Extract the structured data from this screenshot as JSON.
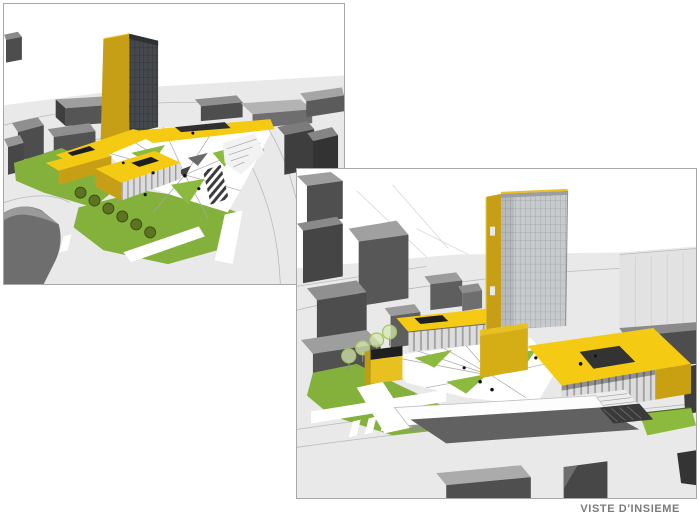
{
  "page": {
    "caption": "VISTE D'INSIEME",
    "background": "#ffffff"
  },
  "palette": {
    "paper": "#ffffff",
    "figureBorder": "#a8a8a8",
    "captionText": "#7b7b7b",
    "yellowRoof": "#f5ca12",
    "yellowWall": "#c79f16",
    "yellowBright": "#e8c020",
    "glassDark": "#45484c",
    "glassDarkLine": "#2b2d30",
    "glassLight": "#c7cacd",
    "glassLightLine": "#8f9296",
    "ctxDark": "#4d4d4d",
    "ctxMid": "#6e6e6e",
    "ctxLightTop": "#9e9e9e",
    "ctxPale": "#e2e2e2",
    "ground": "#e9e9e9",
    "roadLine": "#b9b9b9",
    "panel": "#dcdcdc",
    "panelLine": "#9a9a9a",
    "lawn": "#83b13c",
    "lawnBright": "#8cba3e",
    "treeDark": "#5d7322",
    "treeSketch": "#a4c462",
    "plazaWhite": "#ffffff",
    "plazaLine": "#a7a7a7",
    "skylightBlack": "#1f1f1f",
    "skylightBlue": "#cdd8e2",
    "rampDark": "#616161",
    "shadow": "#3c3c3c"
  },
  "figures": [
    {
      "name": "overall-view-1",
      "alt": "Aerial massing render: yellow tower with dark glass facade, yellow low-rise wings, triangular white plaza and green lawns among gray context buildings",
      "position": "top-left"
    },
    {
      "name": "overall-view-2",
      "alt": "Aerial massing render from opposite side: yellow tower with light glass grid, courtyard roof with opening, white canopy over parking ramp, lawns and gray context buildings",
      "position": "bottom-right"
    }
  ]
}
